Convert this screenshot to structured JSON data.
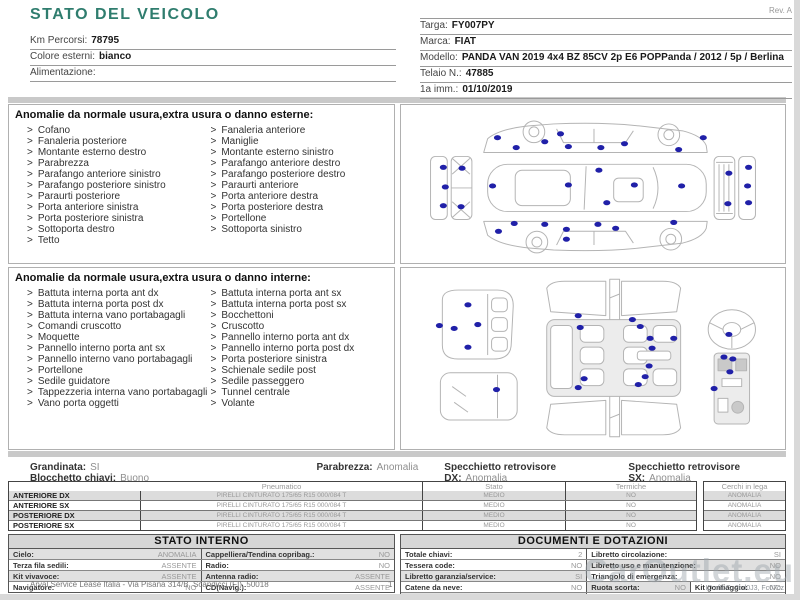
{
  "title": "STATO DEL VEICOLO",
  "rev": "Rev. A",
  "vehicle_info_left": [
    {
      "label": "Km Percorsi:",
      "value": "78795"
    },
    {
      "label": "Colore esterni:",
      "value": "bianco"
    },
    {
      "label": "Alimentazione:",
      "value": ""
    }
  ],
  "vehicle_info_right": [
    {
      "label": "Targa:",
      "value": "FY007PY"
    },
    {
      "label": "Marca:",
      "value": "FIAT"
    },
    {
      "label": "Modello:",
      "value": "PANDA VAN 2019 4x4 BZ 85CV 2p E6 POPPanda / 2012 / 5p / Berlina"
    },
    {
      "label": "Telaio N.:",
      "value": "47885"
    },
    {
      "label": "1a imm.:",
      "value": "01/10/2019"
    }
  ],
  "exterior_anomalies": {
    "header": "Anomalie da normale usura,extra usura o danno esterne:",
    "col1": [
      "Cofano",
      "Fanaleria posteriore",
      "Montante esterno destro",
      "Parabrezza",
      "Parafango anteriore sinistro",
      "Parafango posteriore sinistro",
      "Paraurti posteriore",
      "Porta anteriore sinistra",
      "Porta posteriore sinistra",
      "Sottoporta destro",
      "Tetto"
    ],
    "col2": [
      "Fanaleria anteriore",
      "Maniglie",
      "Montante esterno sinistro",
      "Parafango anteriore destro",
      "Parafango posteriore destro",
      "Paraurti anteriore",
      "Porta anteriore destra",
      "Porta posteriore destra",
      "Portellone",
      "Sottoporta sinistro"
    ]
  },
  "interior_anomalies": {
    "header": "Anomalie da normale usura,extra usura o danno interne:",
    "col1": [
      "Battuta interna porta ant dx",
      "Battuta interna porta post dx",
      "Battuta interna vano portabagagli",
      "Comandi cruscotto",
      "Moquette",
      "Pannello interno porta ant sx",
      "Pannello interno vano portabagagli",
      "Portellone",
      "Sedile guidatore",
      "Tappezzeria interna vano portabagagli",
      "Vano porta oggetti"
    ],
    "col2": [
      "Battuta interna porta ant sx",
      "Battuta interna porta post sx",
      "Bocchettoni",
      "Cruscotto",
      "Pannello interno porta ant dx",
      "Pannello interno porta post dx",
      "Porta posteriore sinistra",
      "Schienale sedile post",
      "Sedile passeggero",
      "Tunnel centrale",
      "Volante"
    ]
  },
  "status_line": {
    "left": [
      {
        "label": "Grandinata:",
        "value": "SI"
      },
      {
        "label": "Blocchetto chiavi:",
        "value": "Buono"
      }
    ],
    "inline": [
      {
        "label": "Parabrezza:",
        "value": "Anomalia"
      },
      {
        "label": "Specchietto retrovisore DX:",
        "value": "Anomalia"
      },
      {
        "label": "Specchietto retrovisore SX:",
        "value": "Anomalia"
      }
    ]
  },
  "tyres": {
    "headers": {
      "pneumatico": "Pneumatico",
      "stato": "Stato",
      "termiche": "Termiche",
      "cerchi": "Cerchi in lega"
    },
    "rows": [
      {
        "position": "ANTERIORE DX",
        "tyre": "PIRELLI CINTURATO 175/65 R15 000/084 T",
        "stato": "MEDIO",
        "termiche": "NO",
        "cerchi": "ANOMALIA"
      },
      {
        "position": "ANTERIORE SX",
        "tyre": "PIRELLI CINTURATO 175/65 R15 000/084 T",
        "stato": "MEDIO",
        "termiche": "NO",
        "cerchi": "ANOMALIA"
      },
      {
        "position": "POSTERIORE DX",
        "tyre": "PIRELLI CINTURATO 175/65 R15 000/084 T",
        "stato": "MEDIO",
        "termiche": "NO",
        "cerchi": "ANOMALIA"
      },
      {
        "position": "POSTERIORE SX",
        "tyre": "PIRELLI CINTURATO 175/65 R15 000/084 T",
        "stato": "MEDIO",
        "termiche": "NO",
        "cerchi": "ANOMALIA"
      }
    ]
  },
  "stato_interno": {
    "header": "STATO INTERNO",
    "rows": [
      {
        "shaded": true,
        "cells": [
          {
            "label": "Cielo:",
            "value": "ANOMALIA"
          },
          {
            "label": "Cappelliera/Tendina copribag.:",
            "value": "NO"
          }
        ]
      },
      {
        "shaded": false,
        "cells": [
          {
            "label": "Terza fila sedili:",
            "value": "ASSENTE"
          },
          {
            "label": "Radio:",
            "value": "NO"
          }
        ]
      },
      {
        "shaded": true,
        "cells": [
          {
            "label": "Kit vivavoce:",
            "value": "ASSENTE"
          },
          {
            "label": "Antenna radio:",
            "value": "ASSENTE"
          }
        ]
      },
      {
        "shaded": false,
        "cells": [
          {
            "label": "Navigatore:",
            "value": "NO"
          },
          {
            "label": "CD(Navig.):",
            "value": "ASSENTE"
          }
        ]
      }
    ]
  },
  "documenti": {
    "header": "DOCUMENTI E DOTAZIONI",
    "rows": [
      {
        "cells": [
          {
            "label": "Totale chiavi:",
            "value": "2",
            "shaded": false
          },
          {
            "label": "Libretto circolazione:",
            "value": "SI",
            "shaded": false
          }
        ]
      },
      {
        "cells": [
          {
            "label": "Tessera code:",
            "value": "NO",
            "shaded": false
          },
          {
            "label": "Libretto uso e manutenzione:",
            "value": "NO",
            "shaded": true
          }
        ]
      },
      {
        "cells": [
          {
            "label": "Libretto garanzia/service:",
            "value": "SI",
            "shaded": true
          },
          {
            "label": "Triangolo di emergenza:",
            "value": "NO",
            "shaded": false
          }
        ]
      },
      {
        "cells": [
          {
            "label": "Catene da neve:",
            "value": "NO",
            "shaded": false
          },
          {
            "label": "Ruota scorta:",
            "value": "NO",
            "shaded": true
          },
          {
            "label": "Kit gonfiaggio:",
            "value": "NO",
            "shaded": false
          }
        ]
      },
      {
        "cells": [
          {
            "label": "Codice autoradio:",
            "value": "NO",
            "shaded": true
          },
          {
            "label": "Cavo elettrico:",
            "value": "",
            "shaded": false
          }
        ]
      }
    ]
  },
  "footer": {
    "left": "Arval Service Lease Italia - Via Pisana 314/B, Scandicci (FI), 50018",
    "page": "1",
    "id_code": "ID:cfIbG, 2cd0J3, Fc07cz"
  },
  "watermark": "CarOutlet.eu",
  "diagram_dots": {
    "exterior": [
      [
        98,
        33
      ],
      [
        117,
        43
      ],
      [
        146,
        37
      ],
      [
        162,
        29
      ],
      [
        170,
        42
      ],
      [
        203,
        43
      ],
      [
        227,
        39
      ],
      [
        282,
        45
      ],
      [
        307,
        33
      ],
      [
        93,
        82
      ],
      [
        170,
        81
      ],
      [
        237,
        81
      ],
      [
        285,
        82
      ],
      [
        209,
        99
      ],
      [
        201,
        66
      ],
      [
        99,
        128
      ],
      [
        115,
        120
      ],
      [
        146,
        121
      ],
      [
        168,
        126
      ],
      [
        200,
        121
      ],
      [
        218,
        125
      ],
      [
        277,
        119
      ],
      [
        168,
        136
      ],
      [
        43,
        63
      ],
      [
        62,
        64
      ],
      [
        45,
        83
      ],
      [
        43,
        102
      ],
      [
        61,
        103
      ],
      [
        333,
        69
      ],
      [
        353,
        63
      ],
      [
        352,
        82
      ],
      [
        332,
        100
      ],
      [
        353,
        99
      ]
    ],
    "interior": [
      [
        68,
        37
      ],
      [
        54,
        61
      ],
      [
        78,
        57
      ],
      [
        39,
        58
      ],
      [
        68,
        80
      ],
      [
        97,
        123
      ],
      [
        180,
        48
      ],
      [
        235,
        52
      ],
      [
        182,
        60
      ],
      [
        243,
        59
      ],
      [
        253,
        71
      ],
      [
        277,
        71
      ],
      [
        255,
        81
      ],
      [
        252,
        99
      ],
      [
        248,
        110
      ],
      [
        186,
        112
      ],
      [
        180,
        121
      ],
      [
        241,
        118
      ],
      [
        333,
        67
      ],
      [
        328,
        90
      ],
      [
        337,
        92
      ],
      [
        334,
        105
      ],
      [
        318,
        122
      ]
    ]
  },
  "colors": {
    "accent": "#2f7d6e",
    "dot": "#2020a8",
    "band": "#c9c9c9",
    "row_alt": "#dcdcdc",
    "value_gray": "#8f8f8f"
  }
}
